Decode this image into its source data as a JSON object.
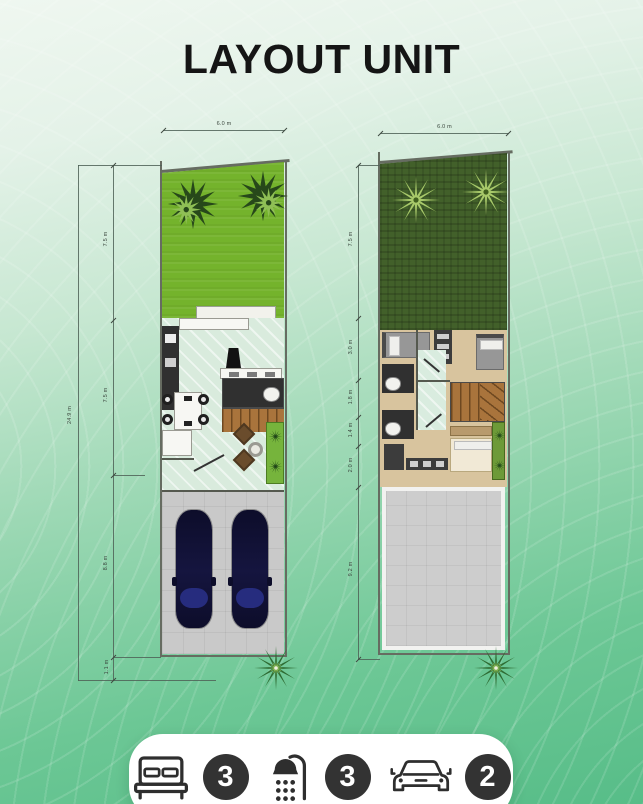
{
  "title": "LAYOUT UNIT",
  "stats": {
    "bedrooms": {
      "icon": "bed-icon",
      "count": "3"
    },
    "bathrooms": {
      "icon": "shower-icon",
      "count": "3"
    },
    "garage": {
      "icon": "car-icon",
      "count": "2"
    }
  },
  "dimensions": {
    "left_width_label": "6.0 m",
    "right_width_label": "6.0 m",
    "left_total_label": "24.9 m",
    "left_segments": [
      "7.5 m",
      "7.5 m",
      "8.8 m",
      "1.1 m"
    ],
    "right_segments": [
      "7.5 m",
      "3.0 m",
      "1.8 m",
      "1.4 m",
      "2.0 m",
      "9.2 m"
    ]
  },
  "colors": {
    "background_top": "#eff7f0",
    "background_bottom": "#57bd88",
    "title_text": "#151515",
    "left_garden_grass": "#74b32c",
    "right_garden_grass": "#42602a",
    "interior_tile": "#d9ebdd",
    "bedroom_floor": "#d8c49e",
    "stairs_wood": "#a9743c",
    "driveway_gray": "#c9c9c9",
    "car_body_navy": "#0d0d2a",
    "stat_badge": "#333333",
    "pill_background": "#ffffff"
  }
}
